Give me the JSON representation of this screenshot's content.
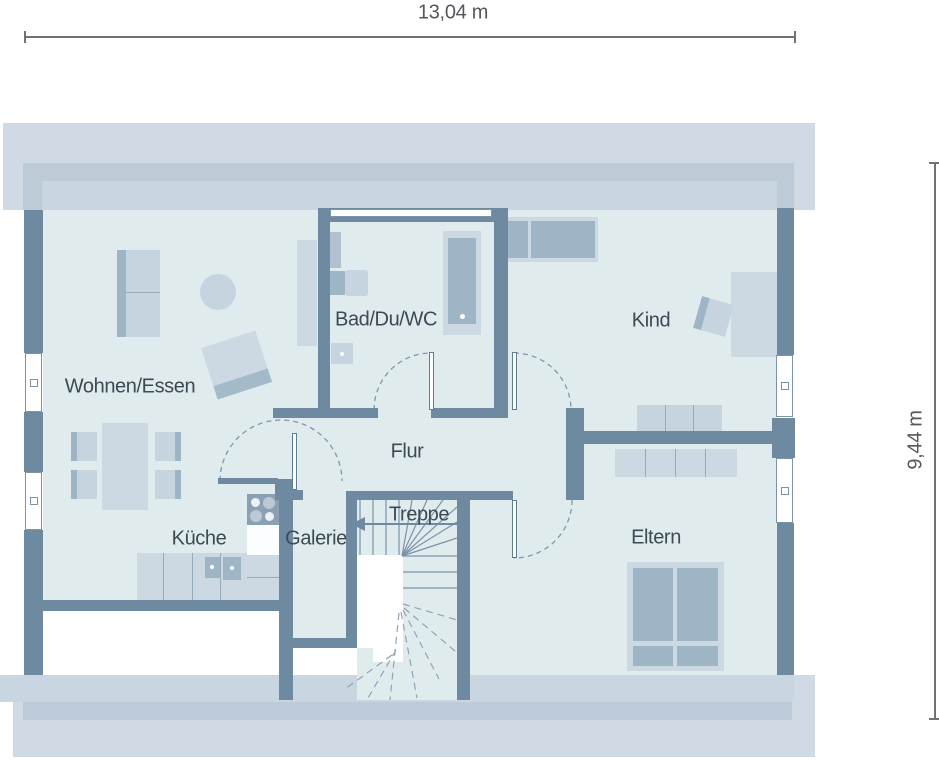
{
  "plan": {
    "dimensions": {
      "width_label": "13,04 m",
      "height_label": "9,44 m"
    },
    "rooms": [
      {
        "label": "Wohnen/Essen"
      },
      {
        "label": "Küche"
      },
      {
        "label": "Galerie"
      },
      {
        "label": "Bad/Du/WC"
      },
      {
        "label": "Flur"
      },
      {
        "label": "Treppe"
      },
      {
        "label": "Kind"
      },
      {
        "label": "Eltern"
      }
    ],
    "colors": {
      "wall": "#6d8aa1",
      "floor": "#e0ebee",
      "roof_overhang_light": "#cfdae4",
      "roof_overhang_medium": "#bdcbd8",
      "roof_overhang_inner": "#c9d5e0",
      "furniture_light": "#c6d4e0",
      "furniture_dark": "#9eb5c5",
      "cooktop": "#8ba1b3",
      "label_text": "#3d4a54",
      "dimension_text": "#54585c"
    }
  }
}
